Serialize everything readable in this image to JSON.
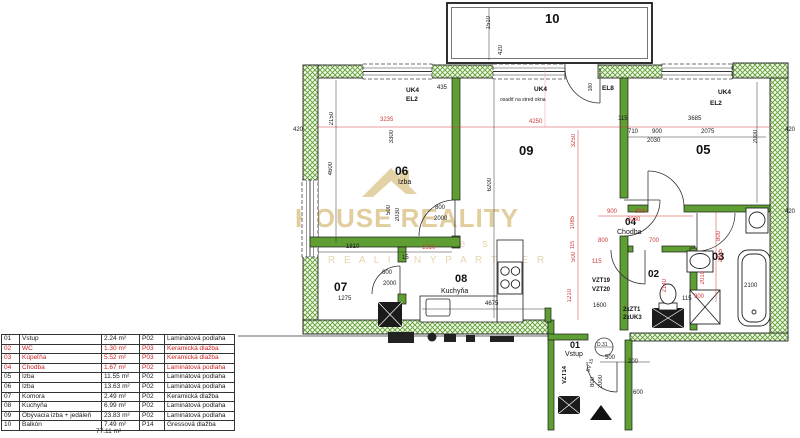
{
  "legend": {
    "rows": [
      {
        "no": "01",
        "name": "Vstup",
        "area": "2.24 m²",
        "code": "P02",
        "floor": "Laminátová podlaha"
      },
      {
        "no": "02",
        "name": "WC",
        "area": "1.30 m²",
        "code": "P03",
        "floor": "Keramická dlažba"
      },
      {
        "no": "03",
        "name": "Kúpeľňa",
        "area": "5.52 m²",
        "code": "P03",
        "floor": "Keramická dlažba"
      },
      {
        "no": "04",
        "name": "Chodba",
        "area": "1.67 m²",
        "code": "P02",
        "floor": "Laminátová podlaha"
      },
      {
        "no": "05",
        "name": "Izba",
        "area": "11.55 m²",
        "code": "P02",
        "floor": "Laminátová podlaha"
      },
      {
        "no": "06",
        "name": "Izba",
        "area": "13.63 m²",
        "code": "P02",
        "floor": "Laminátová podlaha"
      },
      {
        "no": "07",
        "name": "Komora",
        "area": "2.49 m²",
        "code": "P02",
        "floor": "Keramická dlažba"
      },
      {
        "no": "08",
        "name": "Kuchyňa",
        "area": "6.99 m²",
        "code": "P02",
        "floor": "Laminátová podlaha"
      },
      {
        "no": "09",
        "name": "Obývacia izba + jedáleň",
        "area": "23.83 m²",
        "code": "P02",
        "floor": "Laminátová podlaha"
      },
      {
        "no": "10",
        "name": "Balkón",
        "area": "7.49 m²",
        "code": "P14",
        "floor": "Gressová dlažba"
      }
    ],
    "total": "77.11 m²"
  },
  "rooms": {
    "r01": {
      "no": "01",
      "name": "Vstup"
    },
    "r02": {
      "no": "02"
    },
    "r03": {
      "no": "03"
    },
    "r04": {
      "no": "04",
      "name": "Chodba"
    },
    "r05": {
      "no": "05"
    },
    "r06": {
      "no": "06",
      "name": "Izba"
    },
    "r07": {
      "no": "07"
    },
    "r08": {
      "no": "08",
      "name": "Kuchyňa"
    },
    "r09": {
      "no": "09"
    },
    "r10": {
      "no": "10"
    }
  },
  "labels": {
    "uk4": "UK4",
    "el2": "EL2",
    "el8": "EL8",
    "note": "osadiť na stred okna",
    "vzt19": "VZT19",
    "vzt20": "VZT20",
    "vzt14": "VZT14",
    "zt1": "2xZT1",
    "uk3": "2xUK3",
    "bv15": "BV 15",
    "d31": "D.31"
  },
  "dims": {
    "n15": "15",
    "n115": "115",
    "n180": "180",
    "n200": "200",
    "n420": "420",
    "n435": "435",
    "n500": "500",
    "n600": "600",
    "n700": "700",
    "n710": "710",
    "n800": "800",
    "n900": "900",
    "n1085": "1085",
    "n1210": "1210",
    "n1275": "1275",
    "n1310": "1310",
    "n1510": "1510",
    "n1600": "1600",
    "n1810": "1810",
    "n2000": "2000",
    "n2010": "2010",
    "n2030": "2030",
    "n2075": "2075",
    "n2100": "2100",
    "n2140": "2140",
    "n2150": "2150",
    "n2865": "2865",
    "n3235": "3235",
    "n3250": "3250",
    "n3300": "3300",
    "n3685": "3685",
    "n4250": "4250",
    "n4600": "4600",
    "n4675": "4675",
    "n6200": "6200"
  },
  "watermark": {
    "line1": "HOUSE REALITY",
    "line2": "e s t a t e s",
    "line3": "R E A L I T N Ý   P A R T N E R"
  },
  "colors": {
    "wall_green": "#5f9e33",
    "dim_red": "#d03a3a",
    "watermark_gold": "#c9a54f",
    "line_black": "#1a1a1a"
  }
}
